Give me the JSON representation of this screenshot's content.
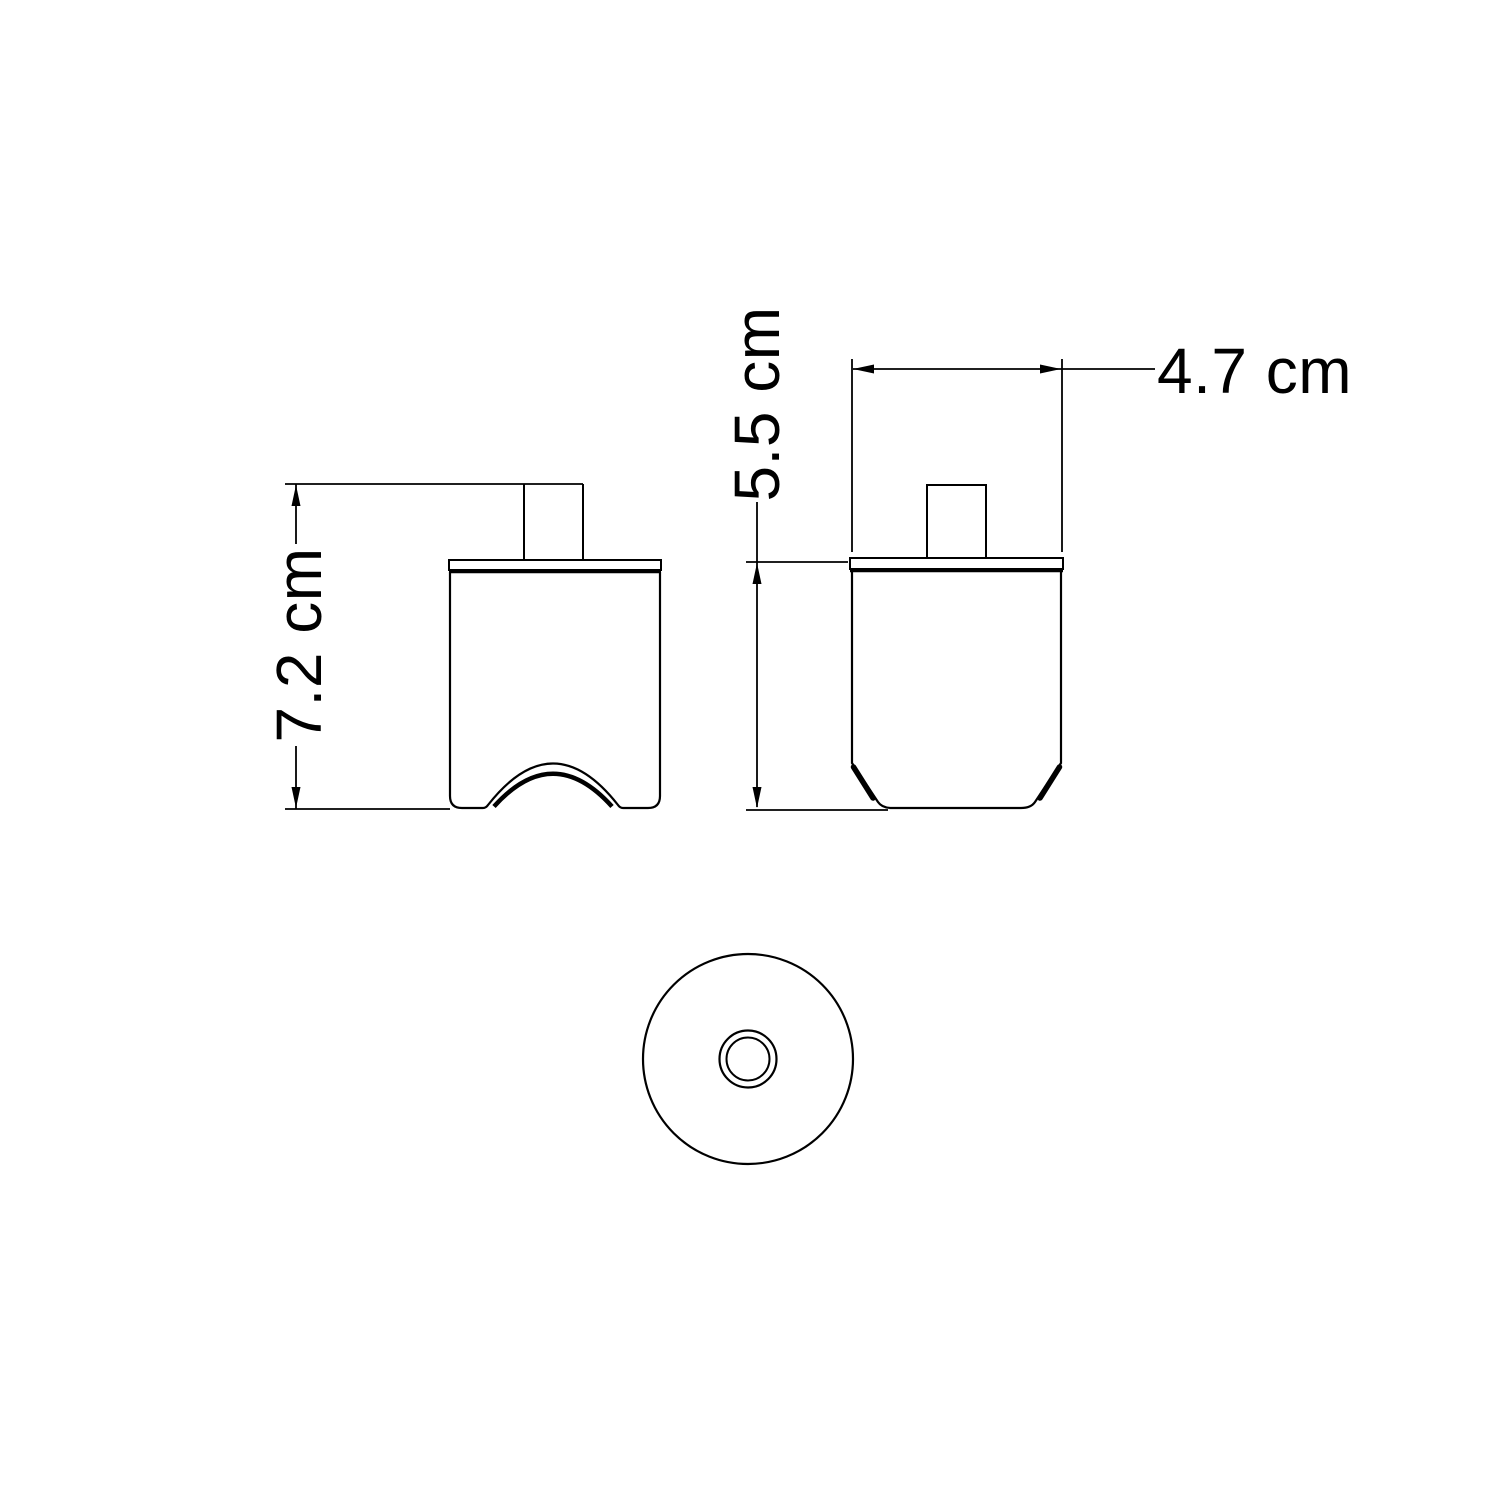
{
  "page": {
    "background_color": "#ffffff",
    "line_color": "#000000",
    "description": "Technical dimension drawing of a ceiling-rose / lamp holder cap shown in three orthographic views"
  },
  "views": {
    "front": {
      "name": "front view with arched cable cutout"
    },
    "side": {
      "name": "side view with chamfered bottom edges"
    },
    "bottom": {
      "name": "bottom view circle with central hole ring"
    }
  },
  "dimensions": {
    "overall_height": {
      "label": "7.2 cm",
      "value": 7.2,
      "unit": "cm"
    },
    "body_height": {
      "label": "5.5 cm",
      "value": 5.5,
      "unit": "cm"
    },
    "body_width": {
      "label": "4.7 cm",
      "value": 4.7,
      "unit": "cm"
    }
  }
}
